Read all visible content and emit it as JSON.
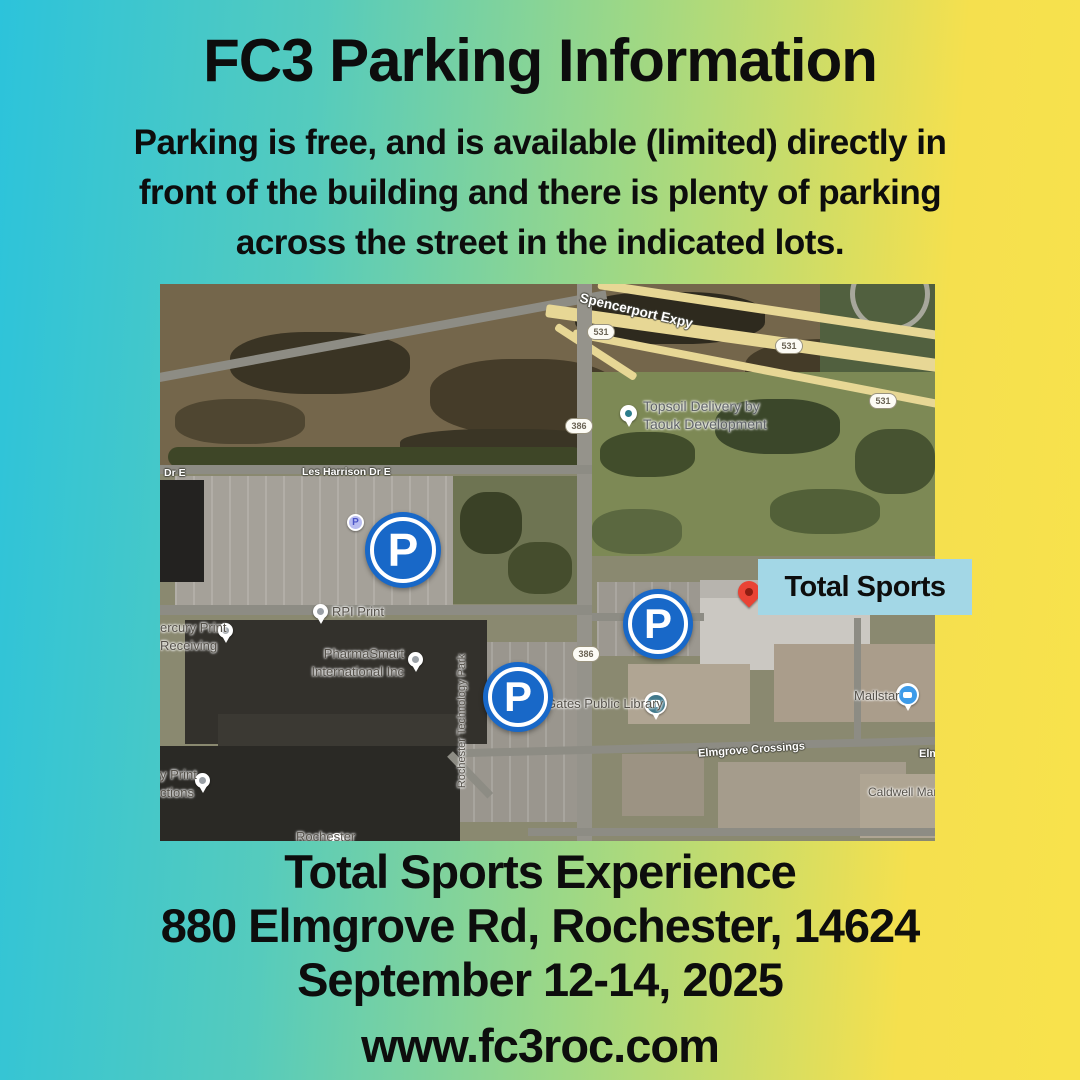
{
  "flyer": {
    "title": "FC3 Parking Information",
    "subtitle_lines": [
      "Parking is free, and is available (limited) directly in",
      "front of the building and there is plenty of parking",
      "across the street in the indicated lots."
    ],
    "footer_lines": [
      "Total Sports Experience",
      "880 Elmgrove Rd, Rochester, 14624",
      "September 12-14, 2025",
      "www.fc3roc.com"
    ]
  },
  "map": {
    "venue_label": "Total Sports",
    "parking_marker_letter": "P",
    "street_labels": [
      {
        "text": "Spencerport Expy"
      },
      {
        "text": "Les Harrison Dr E"
      },
      {
        "text": "Dr E"
      },
      {
        "text": "Elmgrove Crossings"
      },
      {
        "text": "Elm"
      }
    ],
    "route_shields": [
      {
        "text": "531"
      },
      {
        "text": "531"
      },
      {
        "text": "531"
      },
      {
        "text": "386"
      },
      {
        "text": "386"
      }
    ],
    "poi_labels": [
      {
        "text": "Topsoil Delivery by"
      },
      {
        "text": "Taouk Development"
      },
      {
        "text": "RPI Print"
      },
      {
        "text": "ercury Print"
      },
      {
        "text": "Receiving"
      },
      {
        "text": "PharmaSmart"
      },
      {
        "text": "International Inc"
      },
      {
        "text": "Rochester Technology Park"
      },
      {
        "text": "Gates Public Library"
      },
      {
        "text": "Mailstar"
      },
      {
        "text": "Caldwell Man"
      },
      {
        "text": "y Print"
      },
      {
        "text": "ctions"
      },
      {
        "text": "Rochester"
      }
    ],
    "colors": {
      "background_gradient": [
        "#2cc3db",
        "#9ed885",
        "#f5e04e"
      ],
      "parking_marker_blue": "#1868c8",
      "venue_label_bg": "#a3d7e6",
      "venue_pin_red": "#e94335",
      "highway_yellow": "#e7d795"
    }
  }
}
